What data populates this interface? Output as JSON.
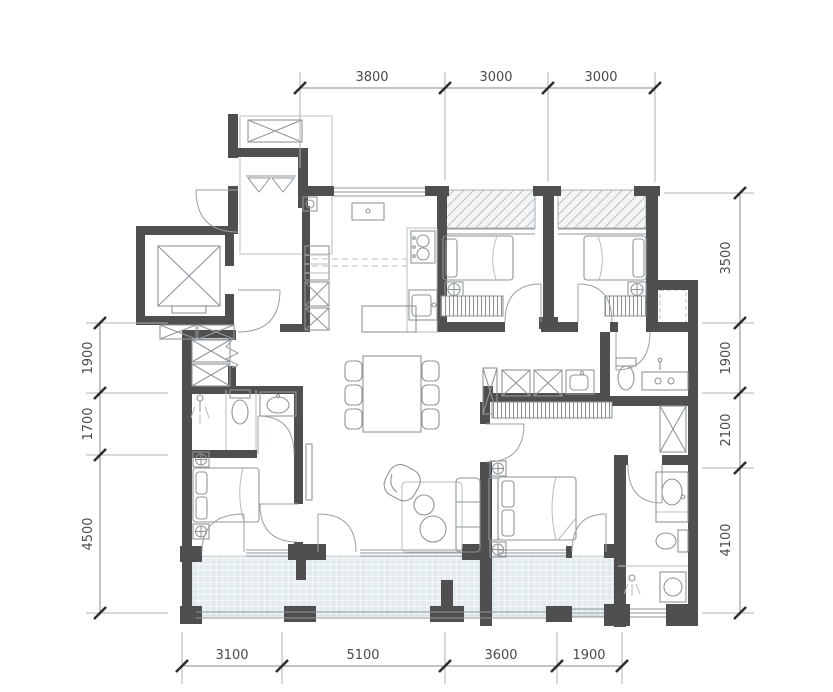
{
  "title": "apartment-floor-plan",
  "dimensions": {
    "top": [
      "3800",
      "3000",
      "3000"
    ],
    "right": [
      "3500",
      "1900",
      "2100",
      "4100"
    ],
    "left": [
      "1900",
      "1700",
      "4500"
    ],
    "bottom": [
      "3100",
      "5100",
      "3600",
      "1900"
    ]
  },
  "colors": {
    "wall": "#4f4f4f",
    "balcony_fill": "#e3ebee",
    "hatch_line": "#b9bfc2",
    "dimension_text": "#4a4a4a"
  }
}
